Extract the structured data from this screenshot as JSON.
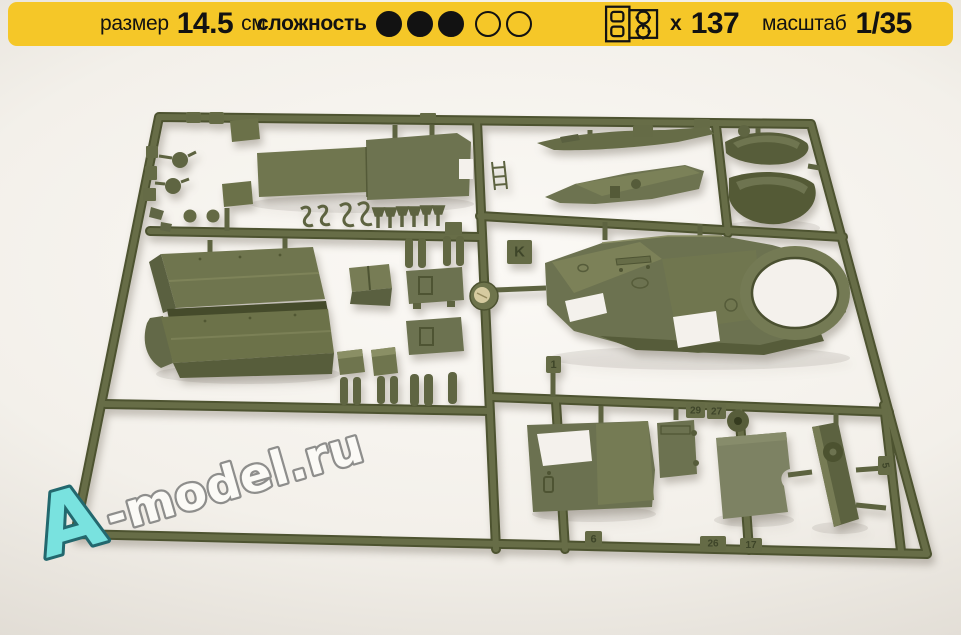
{
  "header": {
    "bg_color": "#F5C728",
    "size": {
      "label": "размер",
      "value": "14.5",
      "unit": "см"
    },
    "difficulty": {
      "label": "сложность",
      "filled": 3,
      "total": 5
    },
    "parts_count": {
      "icon": "sprue-icon",
      "prefix": "x",
      "value": "137"
    },
    "scale": {
      "label": "масштаб",
      "value": "1/35"
    }
  },
  "photo": {
    "description": "olive-green injection-molded sprue with armored-car model kit parts on a light backdrop",
    "plastic_color": "#646a45",
    "sprue_labels": [
      {
        "text": "K"
      },
      {
        "text": "1"
      },
      {
        "text": "29"
      },
      {
        "text": "27"
      },
      {
        "text": "6"
      },
      {
        "text": "26"
      },
      {
        "text": "17"
      },
      {
        "text": "5"
      }
    ]
  },
  "watermark": {
    "prefix": "A",
    "rest": "-model.ru",
    "accent_color": "#79E2DF",
    "outline_color": "#8E8E8C"
  }
}
